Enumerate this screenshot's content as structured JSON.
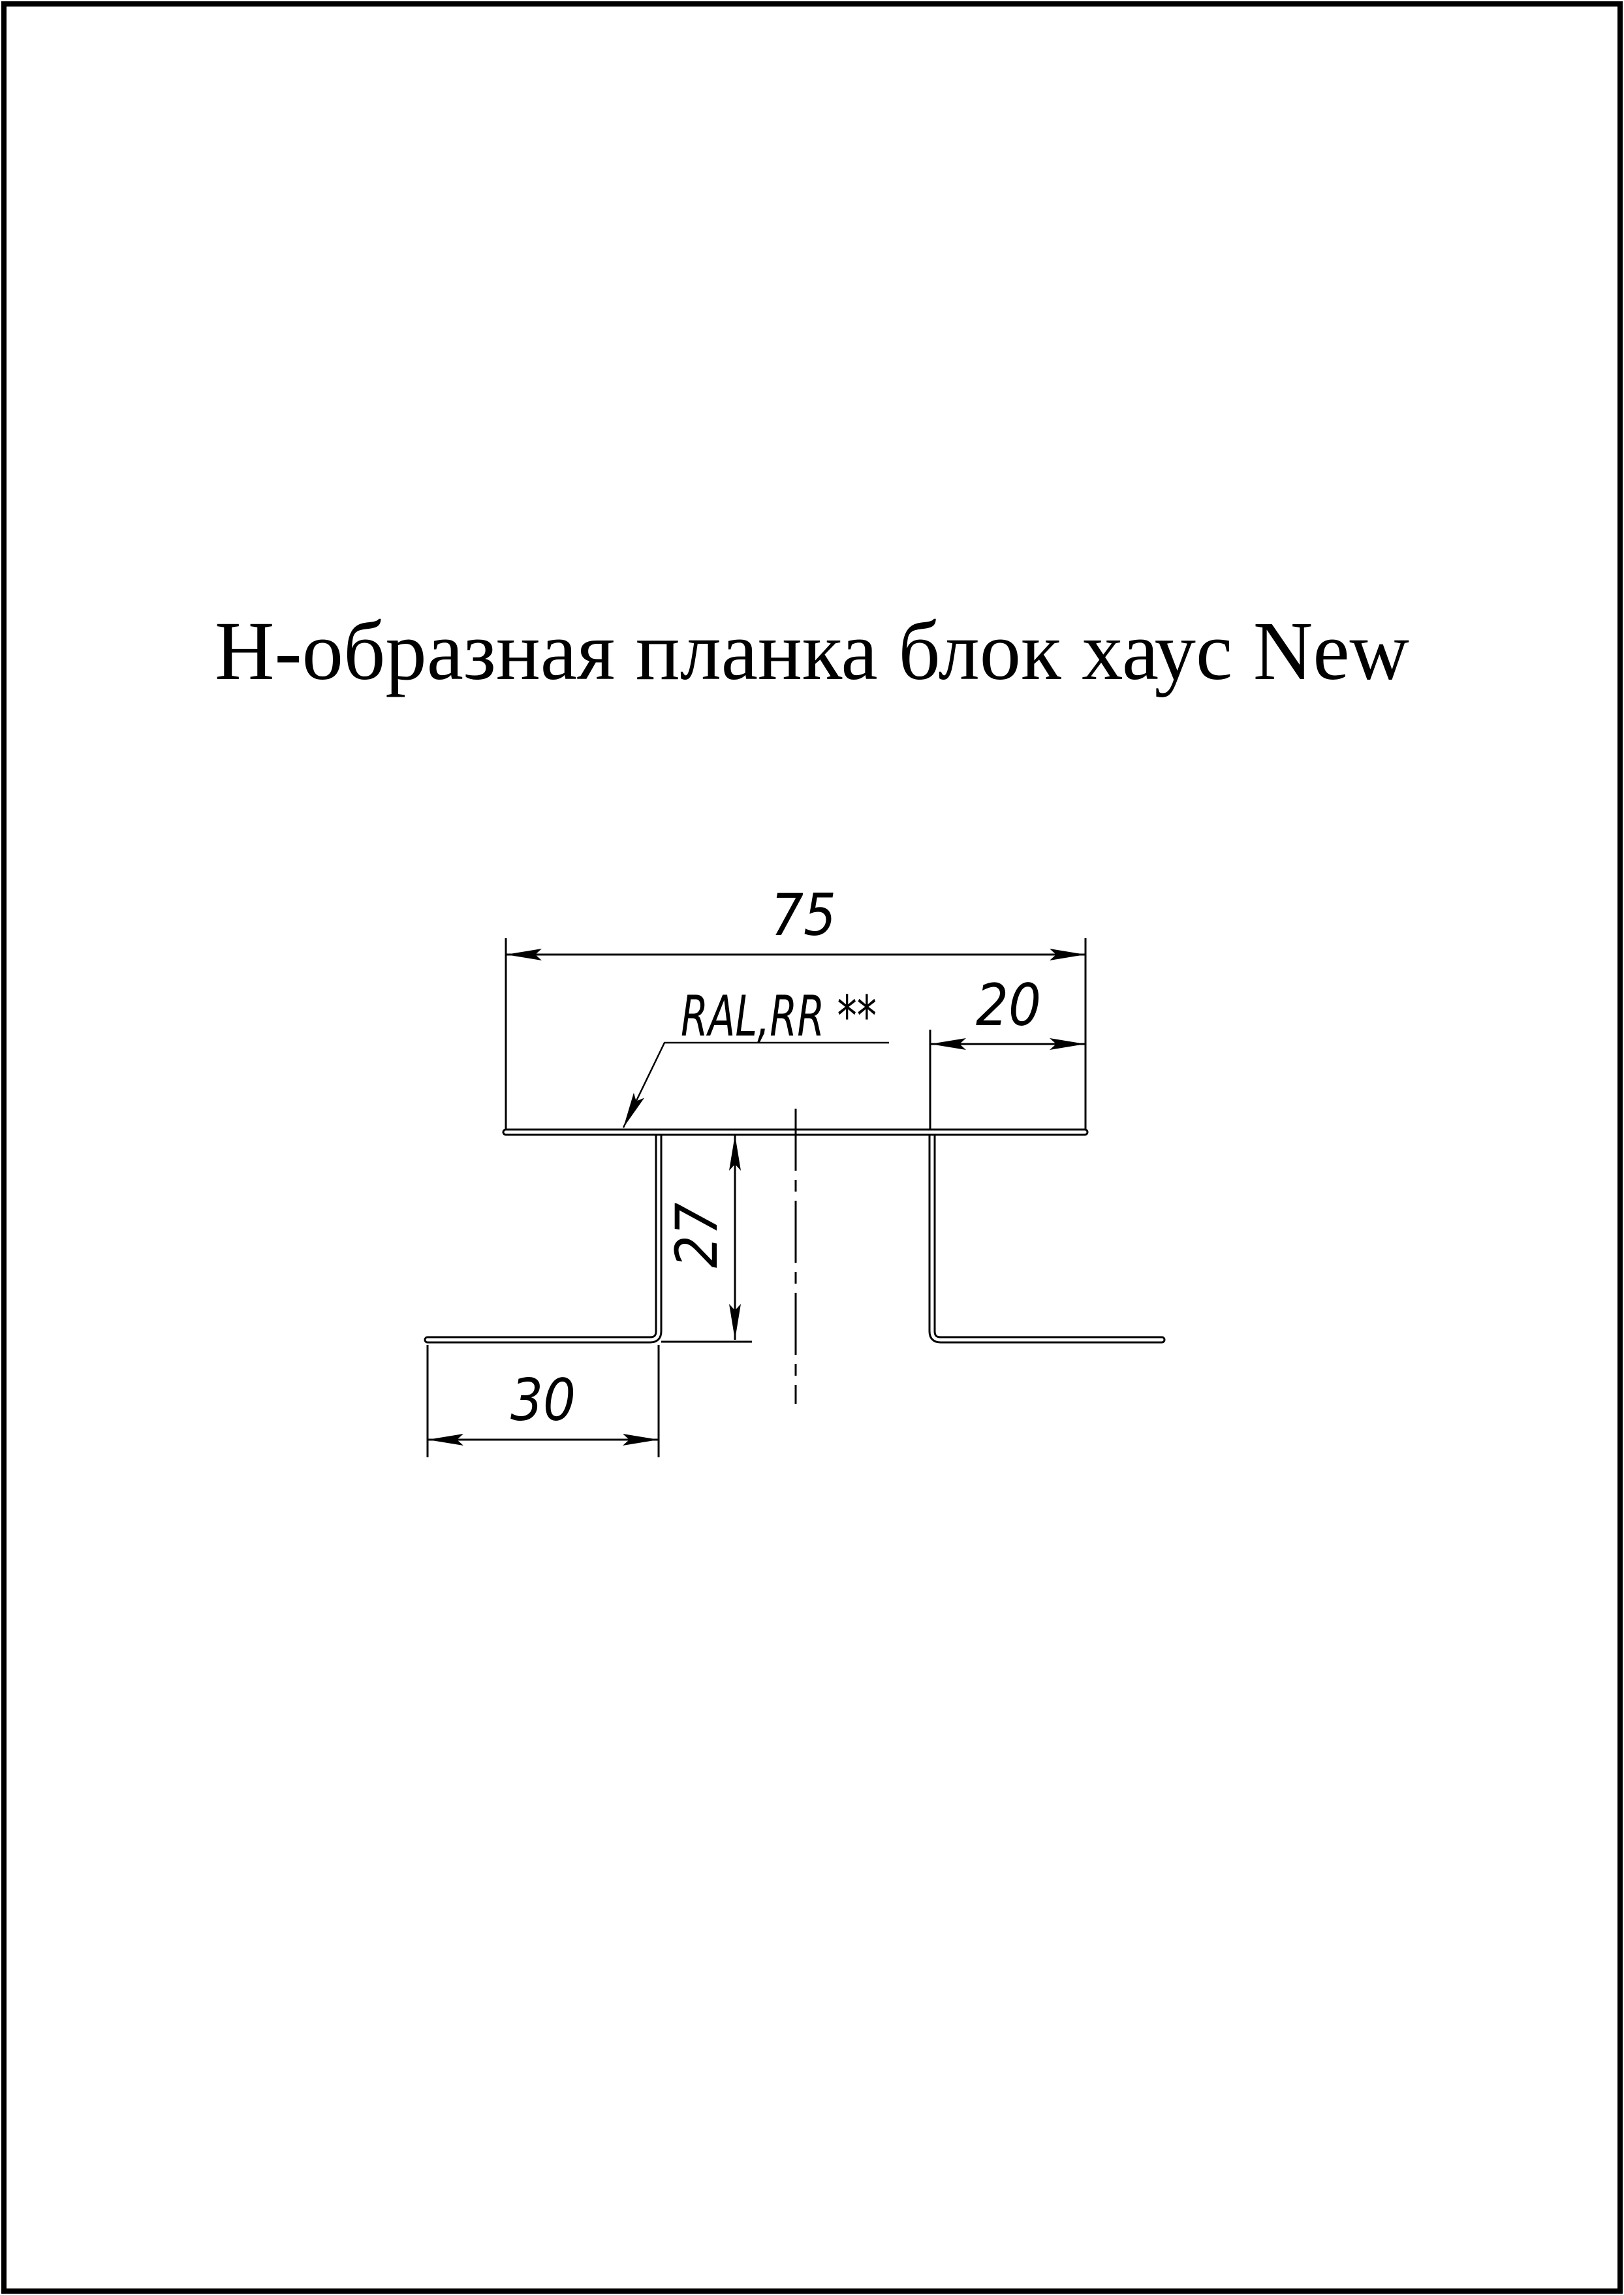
{
  "page": {
    "background_color": "#ffffff",
    "line_color": "#000000"
  },
  "title": "Н-образная планка блок хаус New",
  "drawing": {
    "coating_label": "RAL,RR **",
    "dim_top_width": "75",
    "dim_right_flange": "20",
    "dim_web_height": "27",
    "dim_foot_width": "30"
  },
  "profile": {
    "type": "H-shaped sheet-metal joint strip, cross-section",
    "top_width": 75,
    "side_shelf_width": 20,
    "web_height": 27,
    "foot_width": 30
  }
}
